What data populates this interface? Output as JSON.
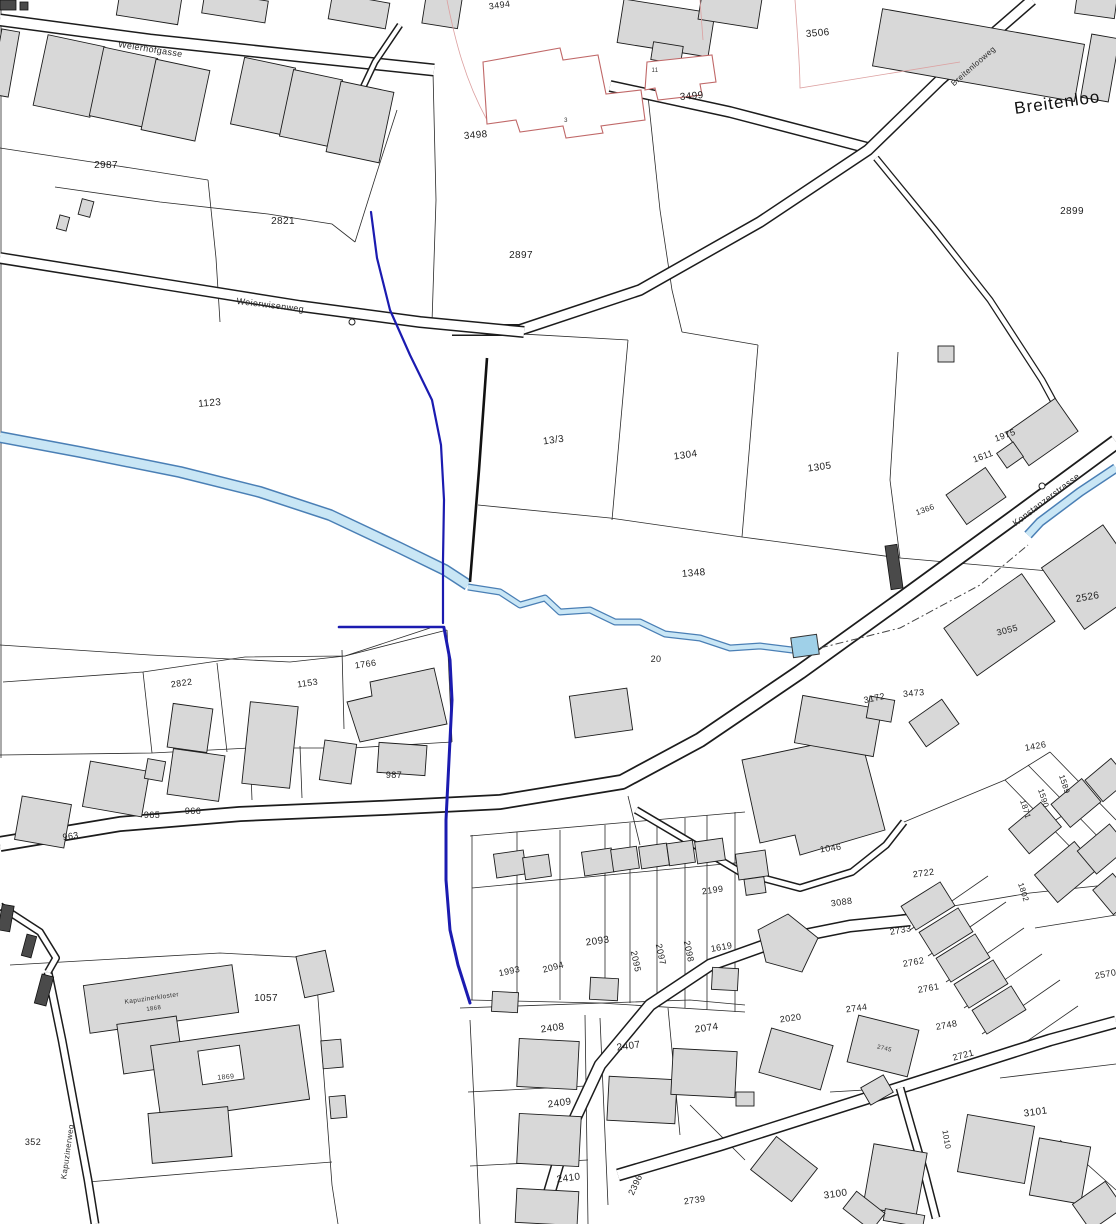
{
  "map": {
    "type": "cadastral-plan",
    "area_name": "Breitenloo",
    "streets": [
      "Weierhofgasse",
      "Breitenlooweg",
      "Weierwisenweg",
      "Konstanzerstrasse",
      "Kapuzinerweg"
    ],
    "colors": {
      "stream_fill": "#c9e6f5",
      "stream_edge": "#4a7fb5",
      "route_blue": "#1b1bb0",
      "planned_red": "#c06868",
      "building_fill": "#d8d8d8",
      "line": "#1c1c1c"
    },
    "labels": [
      {
        "text": "Weierhofgasse",
        "x": 150,
        "y": 52,
        "rot": 9,
        "size": 9,
        "kind": "street"
      },
      {
        "text": "Breitenlooweg",
        "x": 975,
        "y": 68,
        "rot": -41,
        "size": 8,
        "kind": "street"
      },
      {
        "text": "Breitenloo",
        "x": 1058,
        "y": 108,
        "rot": -8,
        "size": 17,
        "kind": "area"
      },
      {
        "text": "Weierwisenweg",
        "x": 270,
        "y": 308,
        "rot": 7,
        "size": 9,
        "kind": "street"
      },
      {
        "text": "Konstanzerstrasse",
        "x": 1048,
        "y": 502,
        "rot": -37,
        "size": 9,
        "kind": "street"
      },
      {
        "text": "Kapuzinerweg",
        "x": 70,
        "y": 1152,
        "rot": -82,
        "size": 8,
        "kind": "street"
      },
      {
        "text": "3506",
        "x": 818,
        "y": 36,
        "rot": -5,
        "size": 10,
        "kind": "parcel"
      },
      {
        "text": "2899",
        "x": 1072,
        "y": 214,
        "rot": 0,
        "size": 10,
        "kind": "parcel"
      },
      {
        "text": "3494",
        "x": 500,
        "y": 8,
        "rot": -8,
        "size": 9,
        "kind": "parcel"
      },
      {
        "text": "3498",
        "x": 476,
        "y": 138,
        "rot": -5,
        "size": 10,
        "kind": "parcel"
      },
      {
        "text": "3499",
        "x": 692,
        "y": 99,
        "rot": -5,
        "size": 10,
        "kind": "parcel"
      },
      {
        "text": "3",
        "x": 566,
        "y": 122,
        "rot": 0,
        "size": 6,
        "kind": "house"
      },
      {
        "text": "11",
        "x": 655,
        "y": 72,
        "rot": 0,
        "size": 6,
        "kind": "house"
      },
      {
        "text": "2987",
        "x": 106,
        "y": 168,
        "rot": 0,
        "size": 10,
        "kind": "parcel"
      },
      {
        "text": "2821",
        "x": 283,
        "y": 224,
        "rot": 0,
        "size": 10,
        "kind": "parcel"
      },
      {
        "text": "2897",
        "x": 521,
        "y": 258,
        "rot": 0,
        "size": 10,
        "kind": "parcel"
      },
      {
        "text": "1123",
        "x": 210,
        "y": 406,
        "rot": -5,
        "size": 10,
        "kind": "parcel"
      },
      {
        "text": "13/3",
        "x": 554,
        "y": 443,
        "rot": -8,
        "size": 10,
        "kind": "parcel"
      },
      {
        "text": "1304",
        "x": 686,
        "y": 458,
        "rot": -8,
        "size": 10,
        "kind": "parcel"
      },
      {
        "text": "1305",
        "x": 820,
        "y": 470,
        "rot": -8,
        "size": 10,
        "kind": "parcel"
      },
      {
        "text": "1348",
        "x": 694,
        "y": 576,
        "rot": -5,
        "size": 10,
        "kind": "parcel"
      },
      {
        "text": "1975",
        "x": 1006,
        "y": 438,
        "rot": -20,
        "size": 9,
        "kind": "parcel"
      },
      {
        "text": "1611",
        "x": 984,
        "y": 459,
        "rot": -20,
        "size": 9,
        "kind": "parcel"
      },
      {
        "text": "1366",
        "x": 926,
        "y": 512,
        "rot": -20,
        "size": 8,
        "kind": "parcel"
      },
      {
        "text": "2526",
        "x": 1088,
        "y": 600,
        "rot": -10,
        "size": 10,
        "kind": "parcel"
      },
      {
        "text": "3055",
        "x": 1008,
        "y": 633,
        "rot": -15,
        "size": 9,
        "kind": "parcel"
      },
      {
        "text": "1426",
        "x": 1036,
        "y": 749,
        "rot": -10,
        "size": 9,
        "kind": "parcel"
      },
      {
        "text": "3172",
        "x": 875,
        "y": 701,
        "rot": -12,
        "size": 9,
        "kind": "parcel"
      },
      {
        "text": "3473",
        "x": 914,
        "y": 696,
        "rot": -5,
        "size": 9,
        "kind": "parcel"
      },
      {
        "text": "20",
        "x": 656,
        "y": 662,
        "rot": 0,
        "size": 9,
        "kind": "parcel"
      },
      {
        "text": "1766",
        "x": 366,
        "y": 667,
        "rot": -8,
        "size": 9,
        "kind": "parcel"
      },
      {
        "text": "1153",
        "x": 308,
        "y": 686,
        "rot": -8,
        "size": 9,
        "kind": "parcel"
      },
      {
        "text": "2822",
        "x": 182,
        "y": 686,
        "rot": -8,
        "size": 9,
        "kind": "parcel"
      },
      {
        "text": "987",
        "x": 394,
        "y": 778,
        "rot": 0,
        "size": 9,
        "kind": "parcel"
      },
      {
        "text": "963",
        "x": 71,
        "y": 839,
        "rot": -8,
        "size": 9,
        "kind": "parcel"
      },
      {
        "text": "965",
        "x": 152,
        "y": 818,
        "rot": 0,
        "size": 9,
        "kind": "parcel"
      },
      {
        "text": "966",
        "x": 193,
        "y": 814,
        "rot": 0,
        "size": 9,
        "kind": "parcel"
      },
      {
        "text": "1993",
        "x": 510,
        "y": 974,
        "rot": -12,
        "size": 9,
        "kind": "parcel"
      },
      {
        "text": "2094",
        "x": 554,
        "y": 970,
        "rot": -15,
        "size": 9,
        "kind": "parcel"
      },
      {
        "text": "2093",
        "x": 598,
        "y": 944,
        "rot": -8,
        "size": 10,
        "kind": "parcel"
      },
      {
        "text": "2095",
        "x": 633,
        "y": 962,
        "rot": 78,
        "size": 9,
        "kind": "parcel"
      },
      {
        "text": "2097",
        "x": 658,
        "y": 955,
        "rot": 78,
        "size": 9,
        "kind": "parcel"
      },
      {
        "text": "2098",
        "x": 686,
        "y": 952,
        "rot": 78,
        "size": 9,
        "kind": "parcel"
      },
      {
        "text": "2199",
        "x": 713,
        "y": 893,
        "rot": -8,
        "size": 9,
        "kind": "parcel"
      },
      {
        "text": "1619",
        "x": 722,
        "y": 950,
        "rot": -10,
        "size": 9,
        "kind": "parcel"
      },
      {
        "text": "3088",
        "x": 842,
        "y": 905,
        "rot": -8,
        "size": 9,
        "kind": "parcel"
      },
      {
        "text": "1046",
        "x": 831,
        "y": 851,
        "rot": -8,
        "size": 9,
        "kind": "parcel"
      },
      {
        "text": "2722",
        "x": 924,
        "y": 876,
        "rot": -8,
        "size": 9,
        "kind": "parcel"
      },
      {
        "text": "2733",
        "x": 901,
        "y": 933,
        "rot": -10,
        "size": 9,
        "kind": "parcel"
      },
      {
        "text": "2762",
        "x": 914,
        "y": 965,
        "rot": -10,
        "size": 9,
        "kind": "parcel"
      },
      {
        "text": "2761",
        "x": 929,
        "y": 991,
        "rot": -10,
        "size": 9,
        "kind": "parcel"
      },
      {
        "text": "2748",
        "x": 947,
        "y": 1028,
        "rot": -10,
        "size": 9,
        "kind": "parcel"
      },
      {
        "text": "2570",
        "x": 1106,
        "y": 977,
        "rot": -10,
        "size": 9,
        "kind": "parcel"
      },
      {
        "text": "1871",
        "x": 1023,
        "y": 810,
        "rot": 72,
        "size": 8,
        "kind": "parcel"
      },
      {
        "text": "1590",
        "x": 1041,
        "y": 799,
        "rot": 72,
        "size": 8,
        "kind": "parcel"
      },
      {
        "text": "1589",
        "x": 1062,
        "y": 785,
        "rot": 72,
        "size": 8,
        "kind": "parcel"
      },
      {
        "text": "1802",
        "x": 1021,
        "y": 893,
        "rot": 72,
        "size": 8,
        "kind": "parcel"
      },
      {
        "text": "2744",
        "x": 857,
        "y": 1011,
        "rot": -8,
        "size": 9,
        "kind": "parcel"
      },
      {
        "text": "2745",
        "x": 884,
        "y": 1050,
        "rot": 14,
        "size": 6,
        "kind": "house"
      },
      {
        "text": "2020",
        "x": 791,
        "y": 1021,
        "rot": -8,
        "size": 9,
        "kind": "parcel"
      },
      {
        "text": "2721",
        "x": 964,
        "y": 1058,
        "rot": -15,
        "size": 9,
        "kind": "parcel"
      },
      {
        "text": "3101",
        "x": 1036,
        "y": 1115,
        "rot": -8,
        "size": 10,
        "kind": "parcel"
      },
      {
        "text": "3100",
        "x": 836,
        "y": 1197,
        "rot": -8,
        "size": 10,
        "kind": "parcel"
      },
      {
        "text": "1010",
        "x": 944,
        "y": 1140,
        "rot": 80,
        "size": 8,
        "kind": "parcel"
      },
      {
        "text": "1057",
        "x": 266,
        "y": 1001,
        "rot": 0,
        "size": 10,
        "kind": "parcel"
      },
      {
        "text": "352",
        "x": 33,
        "y": 1145,
        "rot": 0,
        "size": 9,
        "kind": "parcel"
      },
      {
        "text": "Kapuzinerkloster",
        "x": 152,
        "y": 1000,
        "rot": -8,
        "size": 6.5,
        "kind": "house"
      },
      {
        "text": "1868",
        "x": 154,
        "y": 1010,
        "rot": -8,
        "size": 6,
        "kind": "house"
      },
      {
        "text": "1869",
        "x": 226,
        "y": 1079,
        "rot": -5,
        "size": 7,
        "kind": "house"
      },
      {
        "text": "2408",
        "x": 553,
        "y": 1031,
        "rot": -8,
        "size": 10,
        "kind": "parcel"
      },
      {
        "text": "2407",
        "x": 629,
        "y": 1049,
        "rot": -8,
        "size": 10,
        "kind": "parcel"
      },
      {
        "text": "2074",
        "x": 707,
        "y": 1031,
        "rot": -8,
        "size": 10,
        "kind": "parcel"
      },
      {
        "text": "2409",
        "x": 560,
        "y": 1106,
        "rot": -8,
        "size": 10,
        "kind": "parcel"
      },
      {
        "text": "2410",
        "x": 569,
        "y": 1181,
        "rot": -8,
        "size": 10,
        "kind": "parcel"
      },
      {
        "text": "2396",
        "x": 638,
        "y": 1186,
        "rot": -65,
        "size": 9,
        "kind": "parcel"
      },
      {
        "text": "2739",
        "x": 695,
        "y": 1203,
        "rot": -8,
        "size": 9,
        "kind": "parcel"
      }
    ]
  }
}
